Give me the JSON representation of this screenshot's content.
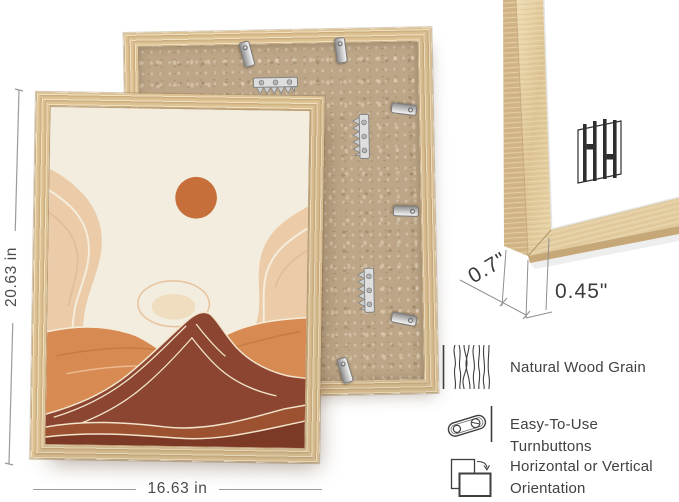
{
  "canvas": {
    "width": 679,
    "height": 502
  },
  "dimensions": {
    "height": "20.63 in",
    "width": "16.63 in",
    "depth": "0.7\"",
    "face": "0.45\""
  },
  "corner_detail": {
    "logo": "HH",
    "logo_icon": "hh-monogram-icon"
  },
  "back_view": {
    "hardware": [
      "turnbuttons",
      "sawtooth-hangers"
    ]
  },
  "features": [
    {
      "icon": "wood-grain-icon",
      "label": "Natural Wood Grain"
    },
    {
      "icon": "turnbutton-icon",
      "label": "Easy-To-Use Turnbuttons"
    },
    {
      "icon": "orientation-icon",
      "label": "Horizontal or Vertical Orientation"
    }
  ],
  "colors": {
    "wood_mid": "#ddc294",
    "wood_dark": "#c9a977",
    "mdf": "#bda687",
    "art_sky": "#f2edde",
    "art_sun": "#c66f3b",
    "art_peach": "#ebcba8",
    "art_orange": "#d78b53",
    "art_maroon": "#8b4530",
    "art_band_mid": "#9c5231",
    "art_band_dark": "#7c3a26",
    "dim_line": "#9a9a9a",
    "text": "#414141",
    "metal": "#cfcfcf"
  }
}
